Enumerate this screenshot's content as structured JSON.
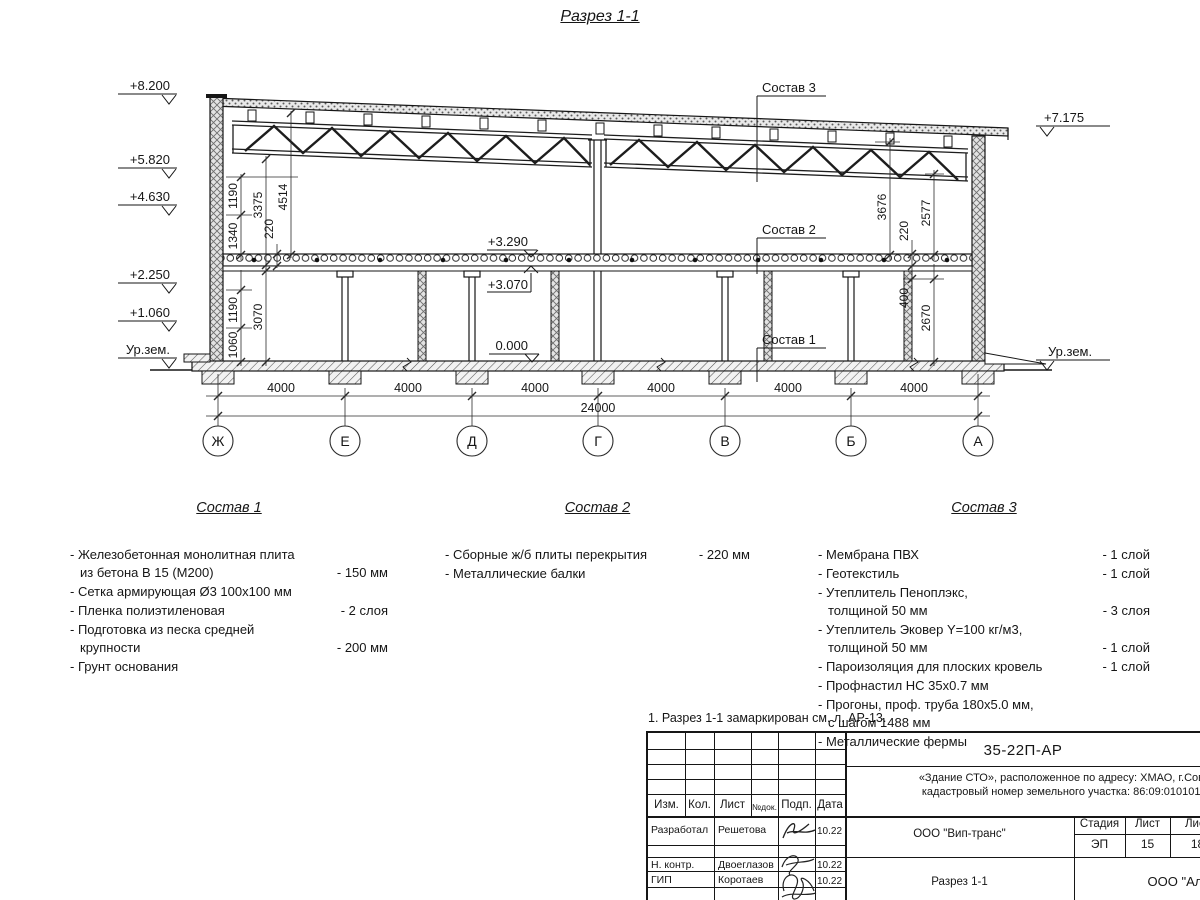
{
  "drawing_title": "Разрез 1-1",
  "colors": {
    "line": "#161616",
    "paper": "#ffffff"
  },
  "elevations": {
    "left": [
      "+8.200",
      "+5.820",
      "+4.630",
      "+2.250",
      "+1.060",
      "Ур.зем."
    ],
    "right_top": "+7.175",
    "right_ground": "Ур.зем.",
    "internal": [
      "+3.290",
      "+3.070",
      "0.000"
    ]
  },
  "dims": {
    "left_chain": [
      "1190",
      "3375",
      "4514",
      "1340",
      "220",
      "1190",
      "3070",
      "1060"
    ],
    "right_chain": [
      "3676",
      "220",
      "2577",
      "400",
      "2670"
    ],
    "bays": [
      "4000",
      "4000",
      "4000",
      "4000",
      "4000",
      "4000"
    ],
    "total": "24000"
  },
  "axes": [
    "Ж",
    "Е",
    "Д",
    "Г",
    "В",
    "Б",
    "А"
  ],
  "section_labels": [
    "Состав 1",
    "Состав 2",
    "Состав 3"
  ],
  "compositions": [
    {
      "title": "Состав 1",
      "items": [
        {
          "text": "- Железобетонная  монолитная плита\nиз бетона В 15 (М200)",
          "value": "- 150 мм"
        },
        {
          "text": "- Сетка армирующая Ø3 100х100 мм",
          "value": ""
        },
        {
          "text": "- Пленка полиэтиленовая",
          "value": "- 2 слоя"
        },
        {
          "text": "- Подготовка из песка средней\nкрупности",
          "value": "- 200 мм"
        },
        {
          "text": "- Грунт основания",
          "value": ""
        }
      ]
    },
    {
      "title": "Состав 2",
      "items": [
        {
          "text": "- Сборные ж/б плиты перекрытия",
          "value": "- 220 мм"
        },
        {
          "text": "- Металлические балки",
          "value": ""
        }
      ]
    },
    {
      "title": "Состав 3",
      "items": [
        {
          "text": "- Мембрана ПВХ",
          "value": "- 1 слой"
        },
        {
          "text": "- Геотекстиль",
          "value": "- 1 слой"
        },
        {
          "text": "- Утеплитель Пеноплэкс,\nтолщиной 50 мм",
          "value": "- 3 слоя"
        },
        {
          "text": "- Утеплитель Эковер Y=100 кг/м3,\nтолщиной 50 мм",
          "value": "- 1 слой"
        },
        {
          "text": "- Пароизоляция для плоских кровель",
          "value": "- 1 слой"
        },
        {
          "text": "- Профнастил НС 35х0.7 мм",
          "value": ""
        },
        {
          "text": "- Прогоны, проф. труба 180х5.0 мм,\nс шагом 1488 мм",
          "value": ""
        },
        {
          "text": "- Металлические фермы",
          "value": ""
        }
      ]
    }
  ],
  "note": "1. Разрез 1-1 замаркирован см. л. АР-13.",
  "title_block": {
    "doc_number": "35-22П-АР",
    "object_line1": "«Здание СТО», расположенное по адресу: ХМАО, г.Советский",
    "object_line2": "кадастровый номер земельного участка: 86:09:0101016:1502",
    "header_cols": [
      "Изм.",
      "Кол.",
      "Лист",
      "№док.",
      "Подп.",
      "Дата"
    ],
    "rows": [
      {
        "role": "Разработал",
        "name": "Решетова",
        "date": "10.22"
      },
      {
        "role": "Н. контр.",
        "name": "Двоеглазов",
        "date": "10.22"
      },
      {
        "role": "ГИП",
        "name": "Коротаев",
        "date": "10.22"
      }
    ],
    "company": "ООО \"Вип-транс\"",
    "sheet_title": "Разрез 1-1",
    "org": "ООО \"Альянс\"",
    "stage_label": "Стадия",
    "sheet_label": "Лист",
    "sheets_label": "Лист",
    "stage": "ЭП",
    "sheet": "15",
    "sheets": "18"
  }
}
